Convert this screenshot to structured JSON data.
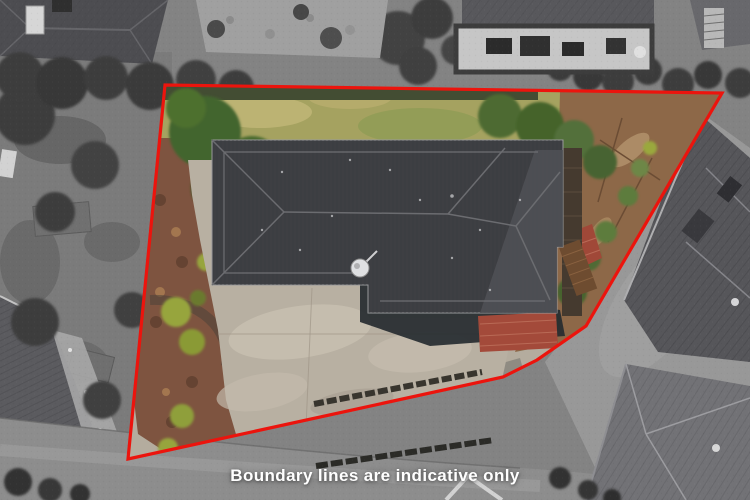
{
  "caption": {
    "text": "Boundary lines are indicative only",
    "color": "#ffffff"
  },
  "boundary": {
    "points": "165,85 722,93 586,326 537,360 503,377 128,459",
    "color": "#ec140d",
    "stroke_width": 3.2
  }
}
